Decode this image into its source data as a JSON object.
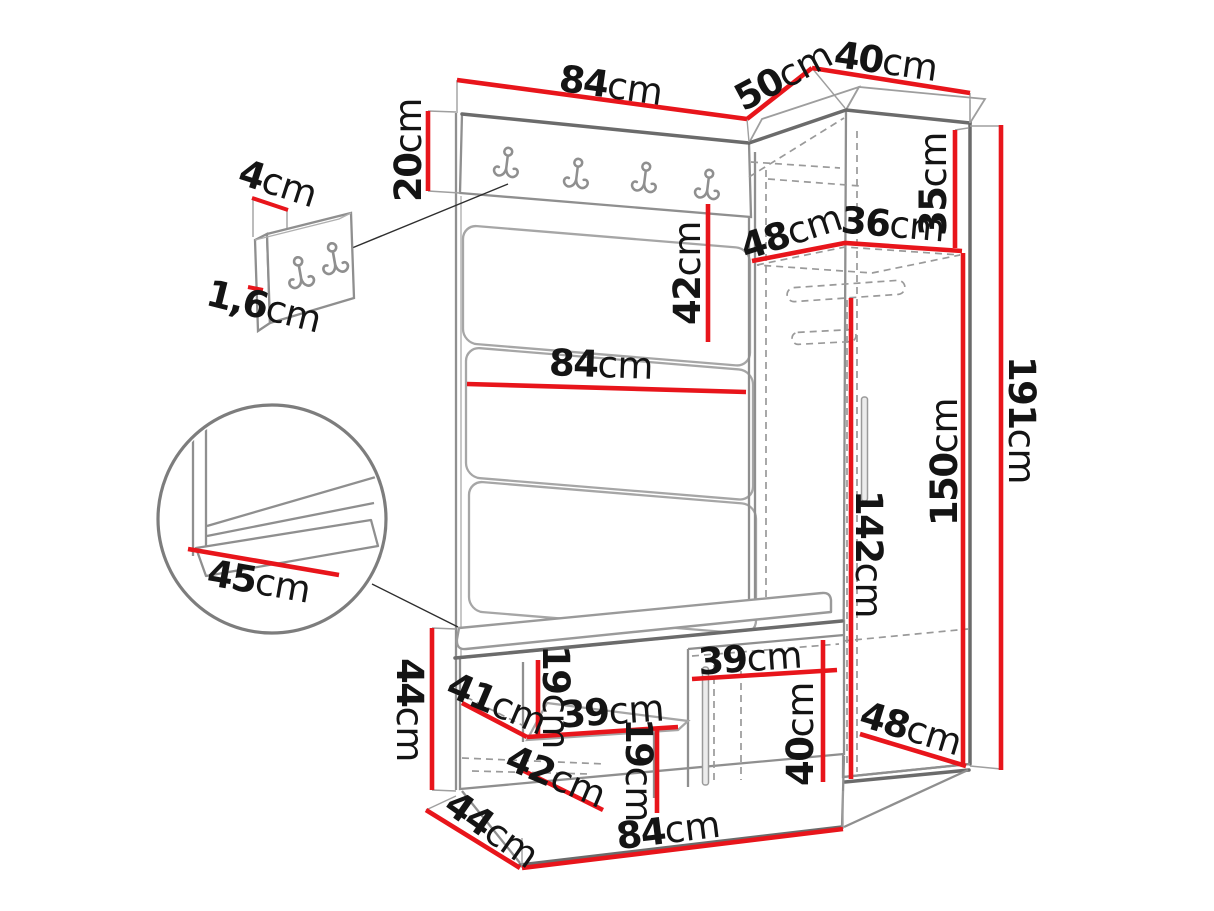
{
  "diagram": {
    "kind": "furniture-dimension-diagram",
    "subject": "hallway set: hook panel with upholstered wall panels, corner wardrobe and shoe bench",
    "units": "cm",
    "colors": {
      "dimension_line": "#e8151b",
      "outline": "#8f8f8f",
      "dark_edge": "#6b6b6b",
      "hidden_line": "#9a9a9a",
      "label_text": "#141414",
      "background": "#ffffff"
    },
    "hooks": {
      "main_panel_double_hooks": 4,
      "detail_panel_double_hooks": 2
    }
  },
  "labels": [
    {
      "id": "top-panel-width",
      "value": "84",
      "unit": "cm"
    },
    {
      "id": "corner-top-depth",
      "value": "50",
      "unit": "cm"
    },
    {
      "id": "wardrobe-top-width",
      "value": "40",
      "unit": "cm"
    },
    {
      "id": "hook-board-height",
      "value": "20",
      "unit": "cm"
    },
    {
      "id": "hook-panel-width",
      "value": "4",
      "unit": "cm"
    },
    {
      "id": "hook-panel-thickness",
      "value": "1,6",
      "unit": "cm"
    },
    {
      "id": "upholstered-row-height",
      "value": "42",
      "unit": "cm"
    },
    {
      "id": "panel-middle-width",
      "value": "84",
      "unit": "cm"
    },
    {
      "id": "corner-shelf-left",
      "value": "48",
      "unit": "cm"
    },
    {
      "id": "corner-shelf-right",
      "value": "36",
      "unit": "cm"
    },
    {
      "id": "top-compartment-height",
      "value": "35",
      "unit": "cm"
    },
    {
      "id": "interior-height",
      "value": "150",
      "unit": "cm"
    },
    {
      "id": "total-height",
      "value": "191",
      "unit": "cm"
    },
    {
      "id": "hanging-rail-height",
      "value": "142",
      "unit": "cm"
    },
    {
      "id": "seat-depth-detail",
      "value": "45",
      "unit": "cm"
    },
    {
      "id": "bench-side-height",
      "value": "44",
      "unit": "cm"
    },
    {
      "id": "bench-upper-opening",
      "value": "19",
      "unit": "cm"
    },
    {
      "id": "bench-shelf-width",
      "value": "39",
      "unit": "cm"
    },
    {
      "id": "bench-upper-depth",
      "value": "41",
      "unit": "cm"
    },
    {
      "id": "bench-lower-depth",
      "value": "42",
      "unit": "cm"
    },
    {
      "id": "bench-lower-opening",
      "value": "19",
      "unit": "cm"
    },
    {
      "id": "bench-door-width",
      "value": "39",
      "unit": "cm"
    },
    {
      "id": "bench-door-height",
      "value": "40",
      "unit": "cm"
    },
    {
      "id": "wardrobe-base-depth",
      "value": "48",
      "unit": "cm"
    },
    {
      "id": "bench-base-depth",
      "value": "44",
      "unit": "cm"
    },
    {
      "id": "bench-width",
      "value": "84",
      "unit": "cm"
    }
  ]
}
